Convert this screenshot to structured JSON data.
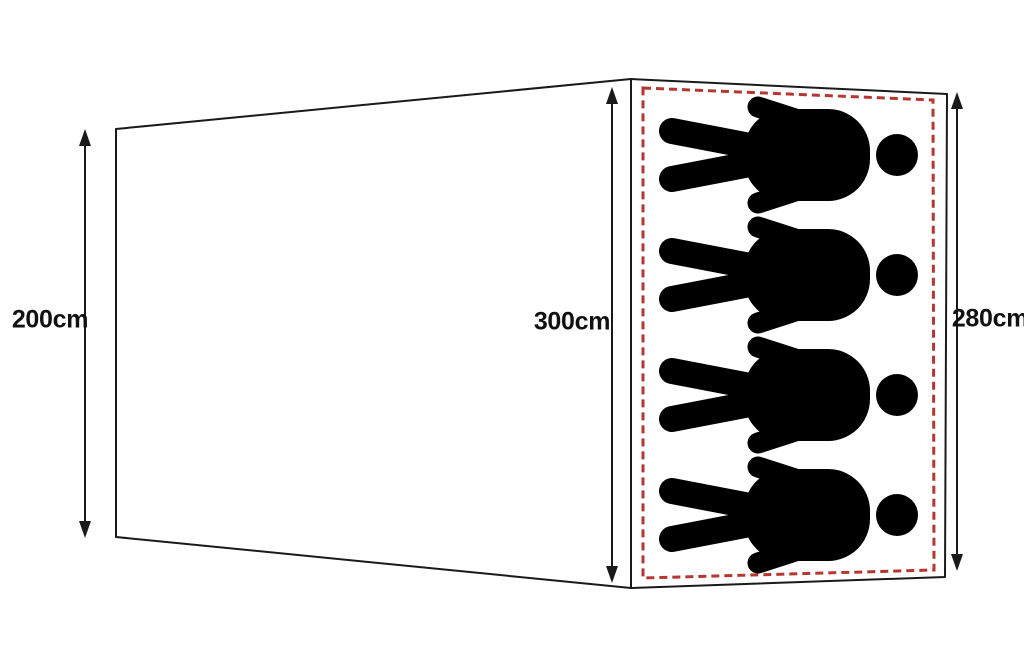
{
  "diagram": {
    "dimensions": {
      "left": {
        "label": "200cm"
      },
      "middle": {
        "label": "300cm"
      },
      "right": {
        "label": "280cm"
      }
    },
    "sleeping_area": {
      "person_count": 4,
      "person_icon": "person-lying-icon",
      "border_style": "dashed",
      "border_color": "#b53732"
    },
    "colors": {
      "outline": "#1a1a1a",
      "background": "#ffffff",
      "figure": "#000000"
    }
  }
}
